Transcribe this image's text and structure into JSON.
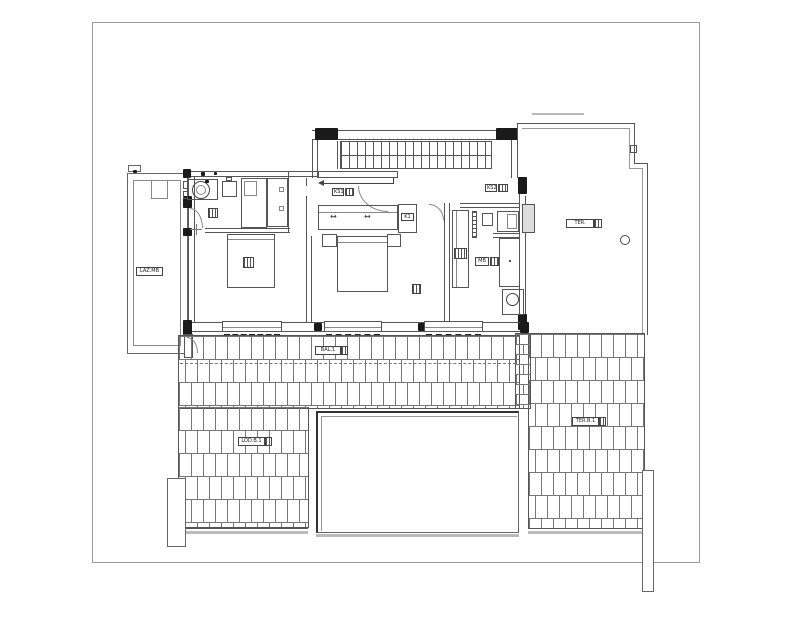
{
  "labels": {
    "balcony": "LAZ.MB",
    "terrace_upper": "TER.",
    "landing": "KS1",
    "hall": "KS2",
    "closet": "K1",
    "bath": "MB",
    "window_band": "BAL.1",
    "roof_left": "LOD.B.1",
    "roof_right": "TER.B.1"
  },
  "glyphs": {
    "slide_arrow": "↔"
  },
  "colors": {
    "line": "#555555",
    "dark": "#1a1a1a",
    "gray": "#bbbbbb",
    "background": "#ffffff"
  }
}
